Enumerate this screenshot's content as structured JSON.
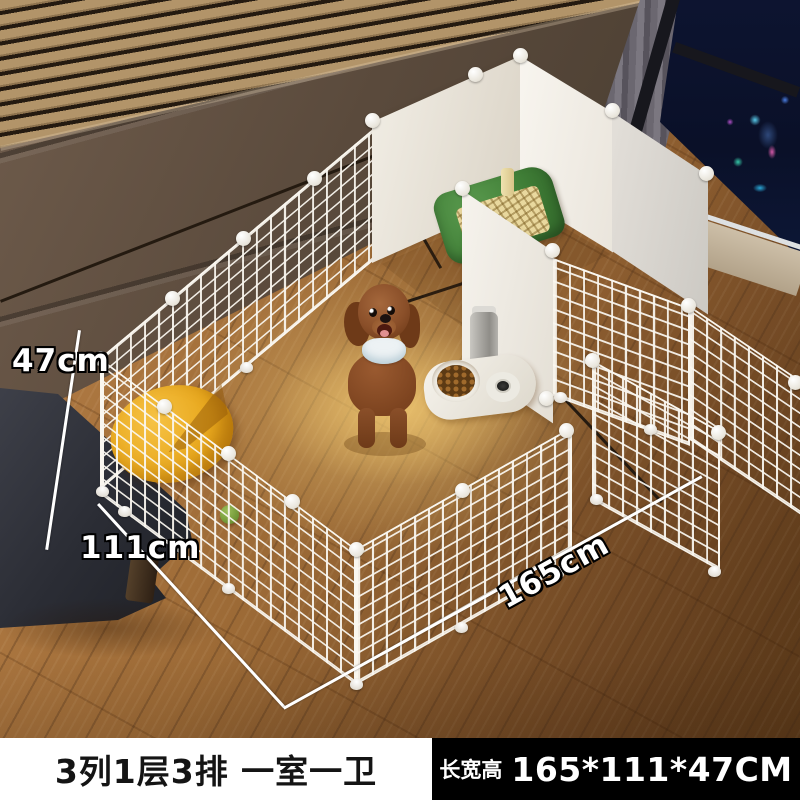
{
  "product": {
    "dimensions": {
      "height_label": "47cm",
      "depth_label": "111cm",
      "length_label": "165cm"
    },
    "caption": {
      "left_text": "3列1层3排 一室一卫",
      "right_prefix": "长宽高",
      "right_value": "165*111*47CM"
    },
    "colors": {
      "caption_left_bg": "#ffffff",
      "caption_left_text": "#141414",
      "caption_right_bg": "#000000",
      "caption_right_text": "#ffffff",
      "annotation_text": "#ffffff",
      "annotation_outline": "#000000",
      "mesh_wire": "#f7f4ee",
      "solid_panel": "#efeae1",
      "wood_floor": "#9c6a36",
      "headboard_wall": "#5a4a3c",
      "litter_tray_green": "#3f7d36",
      "cushion_yellow": "#e8a81e",
      "dog_fur_brown": "#8a4f29",
      "lamp_glow": "#ffd98f"
    }
  }
}
